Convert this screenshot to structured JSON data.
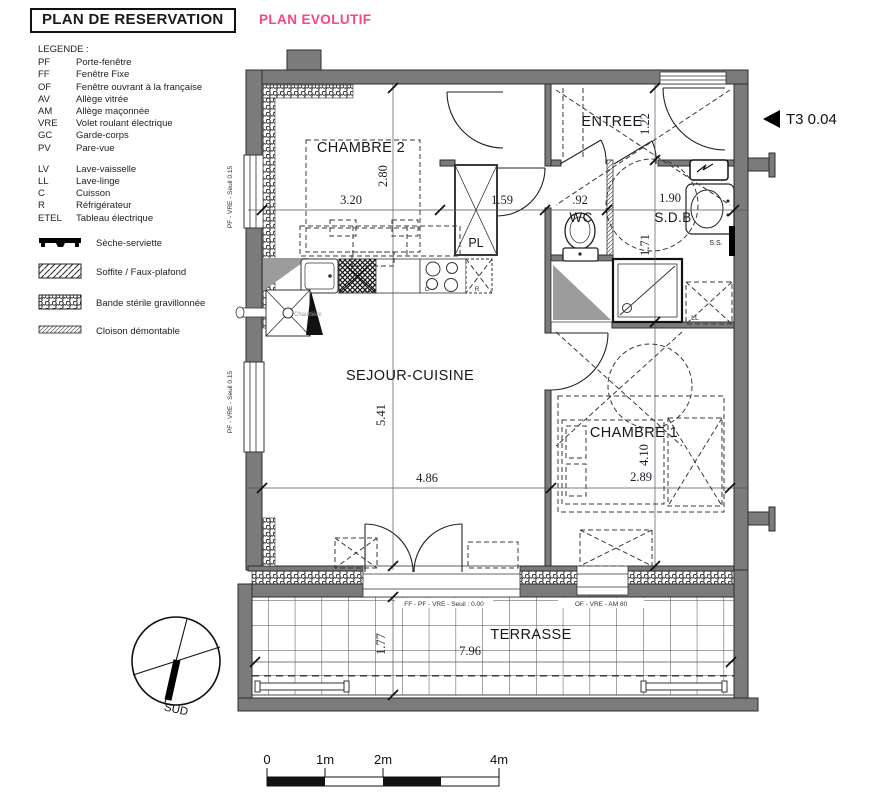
{
  "header": {
    "title": "PLAN DE RESERVATION",
    "subtitle": "PLAN EVOLUTIF"
  },
  "legend": {
    "heading": "LEGENDE :",
    "abbreviations": [
      {
        "code": "PF",
        "label": "Porte-fenêtre"
      },
      {
        "code": "FF",
        "label": "Fenêtre Fixe"
      },
      {
        "code": "OF",
        "label": "Fenêtre ouvrant à la française"
      },
      {
        "code": "AV",
        "label": "Allège vitrée"
      },
      {
        "code": "AM",
        "label": "Allège maçonnée"
      },
      {
        "code": "VRE",
        "label": "Volet roulant électrique"
      },
      {
        "code": "GC",
        "label": "Garde-corps"
      },
      {
        "code": "PV",
        "label": "Pare-vue"
      }
    ],
    "appliances": [
      {
        "code": "LV",
        "label": "Lave-vaisselle"
      },
      {
        "code": "LL",
        "label": "Lave-linge"
      },
      {
        "code": "C",
        "label": "Cuisson"
      },
      {
        "code": "R",
        "label": "Réfrigérateur"
      },
      {
        "code": "ETEL",
        "label": "Tableau électrique"
      }
    ],
    "symbols": [
      {
        "icon": "seche-serviette-icon",
        "label": "Sèche-serviette"
      },
      {
        "icon": "soffite-hatch-icon",
        "label": "Soffite / Faux-plafond"
      },
      {
        "icon": "gravel-band-icon",
        "label": "Bande stérile gravillonnée"
      },
      {
        "icon": "demountable-partition-icon",
        "label": "Cloison démontable"
      }
    ]
  },
  "plan": {
    "unit_label": "T3 0.04",
    "rooms": {
      "chambre2": "CHAMBRE 2",
      "entree": "ENTREE",
      "pl": "PL",
      "wc": "WC",
      "sdb": "S.D.B",
      "sejour": "SEJOUR-CUISINE",
      "chambre1": "CHAMBRE 1",
      "terrasse": "TERRASSE"
    },
    "fixtures": {
      "chaudiere": "Chaudière",
      "lv": "LV",
      "cuisson": "C",
      "refrigerateur": "R",
      "lave_linge": "LL",
      "seche_serviette": "S.S."
    },
    "dimensions": {
      "chambre2_w": "3.20",
      "chambre2_h": "2.80",
      "couloir": "1.59",
      "wc_w": ".92",
      "sdb_w": "1.90",
      "entree_h": "1.22",
      "sdb_h": "1.71",
      "sejour_h": "5.41",
      "sejour_w": "4.86",
      "chambre1_h": "4.10",
      "chambre1_w": "2.89",
      "terrasse_h": "1.77",
      "terrasse_w": "7.96"
    },
    "openings": {
      "left_window_1": "PF - VRE - Seuil 0.15",
      "left_window_2": "PF - VRE - Seuil 0.15",
      "terrace_door": "FF - PF - VRE - Seuil : 0.00",
      "terrace_window": "OF - VRE - AM 80"
    }
  },
  "compass": {
    "label": "SUD"
  },
  "scale_bar": {
    "labels": [
      "0",
      "1m",
      "2m",
      "4m"
    ]
  },
  "colors": {
    "accent_pink": "#f9477d",
    "wall_gray": "#7b7b7b"
  }
}
